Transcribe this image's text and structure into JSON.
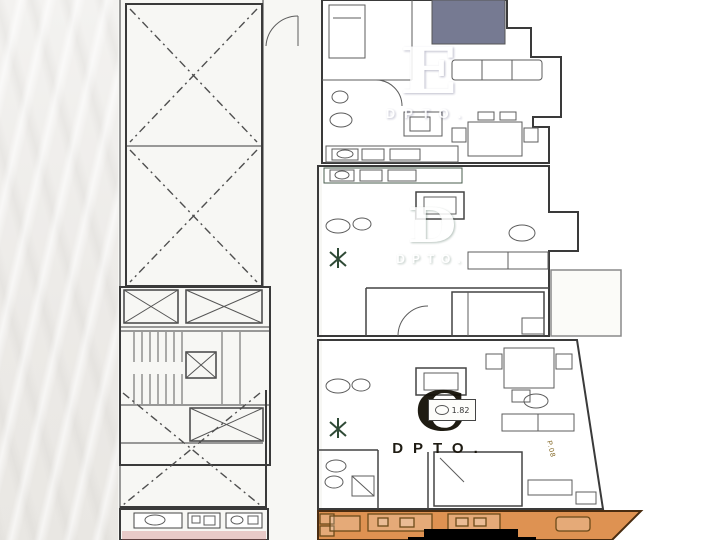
{
  "colors": {
    "canvas": "#ffffff",
    "left_strip": "#eeedea",
    "plan_bg": "#f7f7f4",
    "wall": "#3a3a3a",
    "dark_block": "#767a92",
    "terrace": "#fbfbf8"
  },
  "apartments": [
    {
      "id": "e",
      "letter": "E",
      "sublabel": "DPTO.",
      "fill": "#afade2",
      "label_color": "#ffffff"
    },
    {
      "id": "d",
      "letter": "D",
      "sublabel": "DPTO.",
      "fill": "#83a88d",
      "label_color": "#ffffff"
    },
    {
      "id": "c",
      "letter": "C",
      "sublabel": "DPTO.",
      "fill": "#eec855",
      "label_color": "#141007"
    },
    {
      "id": "b",
      "fill": "#de9252"
    },
    {
      "id": "kitchenette",
      "fill": "#e9a09b"
    }
  ],
  "annotations": {
    "sink_unit_label": "1.82",
    "edge_note": "P.08"
  }
}
